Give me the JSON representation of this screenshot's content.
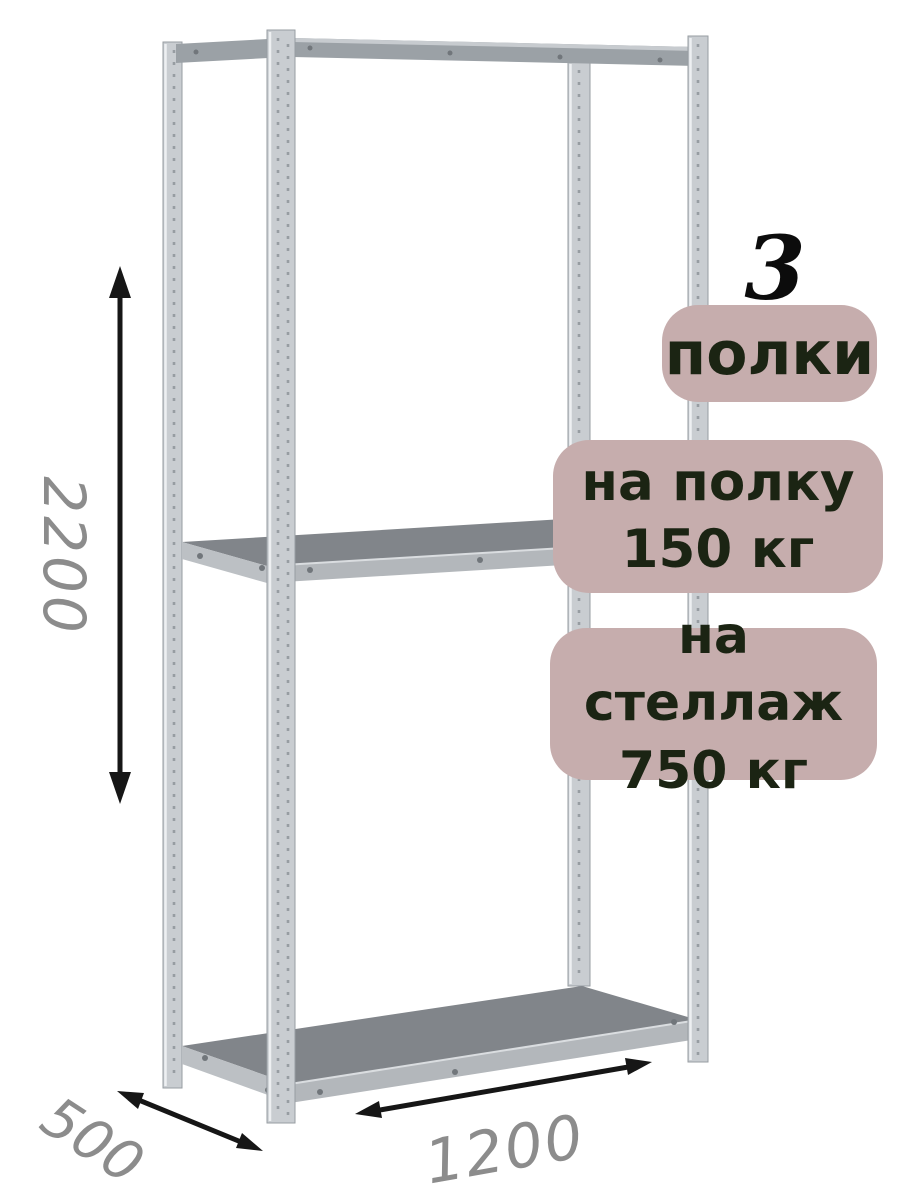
{
  "annotations": {
    "shelf_count": {
      "value": "3",
      "label": "полки"
    },
    "per_shelf": {
      "line1": "на полку",
      "line2": "150 кг"
    },
    "per_rack": {
      "line1": "на стеллаж",
      "line2": "750 кг"
    }
  },
  "dimensions": {
    "height": "2200",
    "depth": "500",
    "width": "1200"
  },
  "icons": {
    "height_arrow": "vertical-double-arrow",
    "width_arrow": "diagonal-double-arrow",
    "depth_arrow": "diagonal-double-arrow"
  },
  "colors": {
    "page_bg": "#ffffff",
    "badge_bg": "#c6adad",
    "badge_text": "#1b2413",
    "dimension_text": "#8c8c8c",
    "arrow": "#161616",
    "metal_light": "#c9cdd1",
    "metal_mid": "#9ba1a6",
    "metal_dark": "#979da2",
    "shelf_top": "#81858a",
    "shelf_edge": "#b3b7bb"
  }
}
